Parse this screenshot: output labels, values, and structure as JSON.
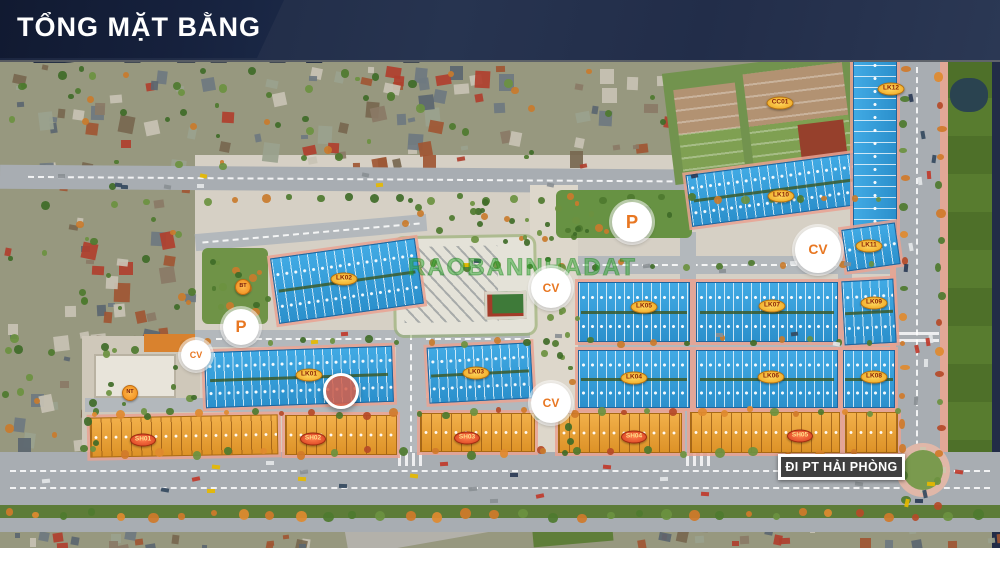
{
  "header": {
    "title": "TỔNG MẶT BẰNG"
  },
  "watermarks": {
    "draft": "DRAFT",
    "listing_site": "RAOBANNHADAT"
  },
  "road_sign": {
    "label": "ĐI PT HẢI PHÒNG"
  },
  "colors": {
    "banner_navy": "#16213d",
    "townhouse_roof_blue": "#2f9ad8",
    "shophouse_roof_orange": "#e8a33c",
    "marker_accent_orange": "#e87722",
    "lot_label_fill": "#f2b02c",
    "shop_label_fill": "#d9482a",
    "field_green": "#4e7029"
  },
  "markers": {
    "parking": [
      {
        "label": "P",
        "x": 241,
        "y": 327,
        "d": 36
      },
      {
        "label": "P",
        "x": 632,
        "y": 222,
        "d": 40
      }
    ],
    "parks": [
      {
        "label": "CV",
        "x": 196,
        "y": 355,
        "d": 30
      },
      {
        "label": "CV",
        "x": 551,
        "y": 288,
        "d": 40
      },
      {
        "label": "CV",
        "x": 551,
        "y": 403,
        "d": 40
      },
      {
        "label": "CV",
        "x": 818,
        "y": 250,
        "d": 46
      }
    ],
    "townhouse_lots": [
      {
        "label": "LK01",
        "x": 309,
        "y": 375
      },
      {
        "label": "LK02",
        "x": 344,
        "y": 279
      },
      {
        "label": "LK03",
        "x": 476,
        "y": 373
      },
      {
        "label": "LK04",
        "x": 634,
        "y": 378
      },
      {
        "label": "LK05",
        "x": 644,
        "y": 307
      },
      {
        "label": "LK06",
        "x": 771,
        "y": 377
      },
      {
        "label": "LK07",
        "x": 772,
        "y": 306
      },
      {
        "label": "LK08",
        "x": 874,
        "y": 377
      },
      {
        "label": "LK09",
        "x": 874,
        "y": 303
      },
      {
        "label": "LK10",
        "x": 781,
        "y": 196
      },
      {
        "label": "LK11",
        "x": 869,
        "y": 246
      },
      {
        "label": "LK12",
        "x": 891,
        "y": 89
      }
    ],
    "shophouse_lots": [
      {
        "label": "SH01",
        "x": 143,
        "y": 440
      },
      {
        "label": "SH02",
        "x": 313,
        "y": 439
      },
      {
        "label": "SH03",
        "x": 467,
        "y": 438
      },
      {
        "label": "SH04",
        "x": 634,
        "y": 437
      },
      {
        "label": "SH05",
        "x": 800,
        "y": 436
      }
    ],
    "apartment_lots": [
      {
        "label": "CC01",
        "x": 780,
        "y": 103
      }
    ],
    "amenities": [
      {
        "label": "BT",
        "x": 243,
        "y": 287
      },
      {
        "label": "NT",
        "x": 130,
        "y": 393
      }
    ],
    "highlight_lot": {
      "x": 341,
      "y": 391,
      "d": 36
    }
  }
}
